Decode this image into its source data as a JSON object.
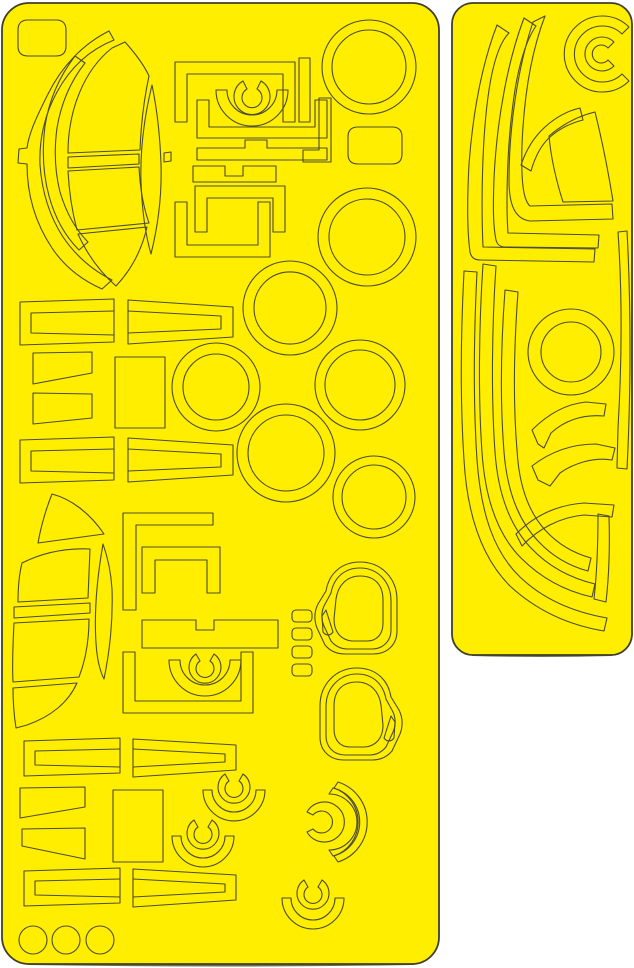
{
  "meta": {
    "content_type": "die-cut vinyl paint mask sheets scan",
    "sheet_count": 2,
    "text_content": "none"
  },
  "colors": {
    "background": "#ffffff",
    "sheet_fill": "#ffee00",
    "cut_line": "#4c4c33",
    "sheet_border": "#3f3f2a",
    "shadow": "#6e6e52"
  },
  "canvas": {
    "width": 634,
    "height": 968
  },
  "sheets": [
    {
      "name": "left-mask-sheet",
      "frame": {
        "x": 2,
        "y": 3,
        "width": 437,
        "height": 961,
        "rx": 27
      },
      "shadow": "M28,963.5 Q221,966.5 414,963.5",
      "shapes": [
        {
          "name": "corner-tab-mask",
          "path": "M28,20 H56 Q66,20 66,30 V46 Q66,56 56,56 H28 Q18,56 18,46 V30 Q18,20 28,20 Z"
        },
        {
          "name": "windshield-outer-arc-mask",
          "path": "M109,31 C83,44 62,66 48,94 C36,118 29,133 27,148 L19,149 L18,163 L27,164 C27,196 36,224 52,248 C66,269 84,281 102,289 L112,280 C92,270 76,256 63,237 C50,217 42,192 40,165 C39,139 45,114 57,92 C70,68 89,50 114,40 Z"
        },
        {
          "name": "windshield-mid-arc-mask",
          "path": "M75,56 C59,77 49,100 45,126 C42,150 43,174 49,196 C55,218 65,236 79,250 L88,242 C75,229 66,212 60,192 C55,172 54,150 57,128 C61,104 70,82 85,63 Z"
        },
        {
          "name": "windshield-top-pane-mask",
          "path": "M125,42 C134,52 143,63 149,76 C144,99 141,124 140,150 L68,153 C68,110 84,70 112,48 Z"
        },
        {
          "name": "windshield-leaf-mask",
          "path": "M152,85 C144,118 140,150 141,182 C142,210 145,233 151,254 C158,226 162,196 161,164 C160,136 157,109 152,85 Z"
        },
        {
          "name": "windshield-equator-strip-mask",
          "path": "M68,157 L139,154 L139,164 L68,168 Z"
        },
        {
          "name": "windshield-equator-stub-mask",
          "path": "M164,153 L171,152 L171,161 L164,162 Z"
        },
        {
          "name": "windshield-lower-pane-mask",
          "path": "M68,171 L139,167 C140,187 143,206 149,223 L77,230 C72,211 69,191 68,171 Z"
        },
        {
          "name": "windshield-bottom-wedge-mask",
          "path": "M78,234 L147,227 C142,249 132,269 116,286 C100,272 87,254 78,234 Z"
        },
        {
          "name": "canopy-staple-frame-mask",
          "path": "M175,62 H295 V122 H283 V74 H187 V122 H175 Z"
        },
        {
          "name": "canopy-side-bar-mask",
          "path": "M299,58 H310 V122 H299 Z"
        },
        {
          "name": "canopy-corner-bracket-mask",
          "path": "M319,98 H331 V162 H303 V150 H319 Z"
        },
        {
          "name": "canopy-u-channel-mask",
          "path": "M197,100 V138 H327 V100 H315 V127 H209 V100 Z"
        },
        {
          "name": "canopy-fan-arc-mask",
          "path": "M216,90 A36,36 0 0 0 288,90 L277,90 A25,25 0 0 1 227,90 Z"
        },
        {
          "name": "canopy-c-ring-mask",
          "path": "M261,81 A18,18 0 1 1 243,81 L247,89 A10,10 0 1 0 257,89 Z"
        },
        {
          "name": "canopy-tab-bar-mask",
          "path": "M197,148 H245 V140 H267 V148 H327 V160 H197 Z"
        },
        {
          "name": "canopy-notch-bar-mask",
          "path": "M193,166 H225 V176 H243 V166 H276 V182 H193 Z"
        },
        {
          "name": "canopy-inner-bracket-mask",
          "path": "M195,232 V186 H285 V232 H273 V198 H207 V232 Z"
        },
        {
          "name": "canopy-lower-u-frame-mask",
          "path": "M175,202 V257 H270 V202 H258 V245 H187 V202 Z"
        },
        {
          "name": "ring-mask-top-1",
          "path": "M322,67 a47,47 0 1 0 94,0 a47,47 0 1 0 -94,0 M332,67 a37,37 0 1 0 74,0 a37,37 0 1 0 -74,0"
        },
        {
          "name": "ring-mask-top-2",
          "path": "M318,237 a49,49 0 1 0 98,0 a49,49 0 1 0 -98,0 M329,237 a38,38 0 1 0 76,0 a38,38 0 1 0 -76,0"
        },
        {
          "name": "rounded-rect-mask",
          "path": "M358,127 H392 Q402,127 402,137 V154 Q402,164 392,164 H358 Q348,164 348,154 V137 Q348,127 358,127 Z"
        },
        {
          "name": "ring-mask-mid-1",
          "path": "M243,308 a47,47 0 1 0 94,0 a47,47 0 1 0 -94,0 M254,308 a36,36 0 1 0 72,0 a36,36 0 1 0 -72,0"
        },
        {
          "name": "ring-mask-mid-2",
          "path": "M172,387 a44,44 0 1 0 88,0 a44,44 0 1 0 -88,0 M183,387 a33,33 0 1 0 66,0 a33,33 0 1 0 -66,0"
        },
        {
          "name": "ring-mask-mid-3",
          "path": "M315,385 a45,45 0 1 0 90,0 a45,45 0 1 0 -90,0 M325,385 a35,35 0 1 0 70,0 a35,35 0 1 0 -70,0"
        },
        {
          "name": "ring-mask-mid-4",
          "path": "M237,453 a49,49 0 1 0 98,0 a49,49 0 1 0 -98,0 M248,453 a38,38 0 1 0 76,0 a38,38 0 1 0 -76,0"
        },
        {
          "name": "ring-mask-mid-5",
          "path": "M333,497 a41,41 0 1 0 82,0 a41,41 0 1 0 -82,0 M342,497 a32,32 0 1 0 64,0 a32,32 0 1 0 -64,0"
        },
        {
          "name": "strip-channel-row1-left-outer",
          "path": "M20,302 L114,299 L114,342 L20,345 Z"
        },
        {
          "name": "strip-channel-row1-left-inner",
          "path": "M114,311 L31,313 L31,333 L114,335"
        },
        {
          "name": "strip-channel-row1-right-outer",
          "path": "M128,300 L233,307 L233,337 L128,344 Z"
        },
        {
          "name": "strip-channel-row1-right-inner",
          "path": "M128,311 L221,316 L221,329 L128,333"
        },
        {
          "name": "trapezoid-mask-1",
          "path": "M33,353 L92,352 L92,373 L33,384 Z"
        },
        {
          "name": "trapezoid-mask-2",
          "path": "M33,393 L92,394 L92,418 L33,424 Z"
        },
        {
          "name": "rect-mask-mid",
          "path": "M115,357 H165 V428 H115 Z"
        },
        {
          "name": "strip-channel-row2-left-outer",
          "path": "M20,440 L114,437 L114,480 L20,483 Z"
        },
        {
          "name": "strip-channel-row2-left-inner",
          "path": "M114,449 L31,451 L31,471 L114,473"
        },
        {
          "name": "strip-channel-row2-right-outer",
          "path": "M128,438 L233,445 L233,475 L128,482 Z"
        },
        {
          "name": "strip-channel-row2-right-inner",
          "path": "M128,449 L221,454 L221,467 L128,471"
        },
        {
          "name": "lower-canopy-top-wedge-mask",
          "path": "M52,494 C71,499 90,513 104,534 L38,543 C41,526 46,509 52,494 Z"
        },
        {
          "name": "lower-canopy-pane-mask",
          "path": "M22,563 C44,552 67,548 90,549 L88,598 L18,602 C18,588 19,575 22,563 Z"
        },
        {
          "name": "lower-canopy-leaf-mask",
          "path": "M103,544 C97,578 94,612 96,643 C97,659 100,671 104,679 C110,650 113,619 112,589 C111,573 108,558 103,544 Z"
        },
        {
          "name": "lower-canopy-equator-strip-mask",
          "path": "M14,607 L90,603 L90,613 L14,618 Z"
        },
        {
          "name": "lower-canopy-pane2-mask",
          "path": "M14,623 L89,619 C89,639 86,659 79,677 L13,682 C12,662 13,642 14,623 Z"
        },
        {
          "name": "lower-canopy-bottom-wedge-mask",
          "path": "M13,688 L77,683 C68,703 50,717 27,725 L16,728 C14,715 13,701 13,688 Z"
        },
        {
          "name": "bracket-l-mask",
          "path": "M123,513 H213 V525 H136 V610 H123 Z"
        },
        {
          "name": "bracket-n-mask",
          "path": "M142,547 H220 V593 H207 V560 H155 V593 H142 Z"
        },
        {
          "name": "notch-bar-mask-2",
          "path": "M142,620 H196 V630 H214 V620 H278 V648 H142 Z"
        },
        {
          "name": "canopy-fan-arc-mask-2",
          "path": "M169,660 A36,36 0 0 0 241,660 L230,660 A25,25 0 0 1 180,660 Z"
        },
        {
          "name": "canopy-c-ring-mask-2",
          "path": "M214,654 A16,16 0 1 1 196,654 L200,661 A9,9 0 1 0 210,661 Z"
        },
        {
          "name": "canopy-staple-frame-mask-2",
          "path": "M123,652 V713 H253 V652 H241 V701 H135 V652 Z"
        },
        {
          "name": "small-tab-mask-1",
          "path": "M296,610 h12 a4,4 0 0 1 4,4 v4 a4,4 0 0 1 -4,4 h-12 a4,4 0 0 1 -4,-4 v-4 a4,4 0 0 1 4,-4 Z"
        },
        {
          "name": "small-tab-mask-2",
          "path": "M296,628 h12 a4,4 0 0 1 4,4 v4 a4,4 0 0 1 -4,4 h-12 a4,4 0 0 1 -4,-4 v-4 a4,4 0 0 1 4,-4 Z"
        },
        {
          "name": "small-tab-mask-3",
          "path": "M296,646 h12 a4,4 0 0 1 4,4 v4 a4,4 0 0 1 -4,4 h-12 a4,4 0 0 1 -4,-4 v-4 a4,4 0 0 1 4,-4 Z"
        },
        {
          "name": "small-tab-mask-4",
          "path": "M296,664 h12 a4,4 0 0 1 4,4 v4 a4,4 0 0 1 -4,4 h-12 a4,4 0 0 1 -4,-4 v-4 a4,4 0 0 1 4,-4 Z"
        },
        {
          "name": "wheel-mask-1-outer",
          "path": "M360,562 C342,562 329,573 326,591 L318,604 C314,612 314,620 317,628 L325,645 C330,651 337,654 345,654 L373,654 C387,654 397,645 397,631 L397,600 C397,578 381,562 360,562 Z"
        },
        {
          "name": "wheel-mask-1-mid",
          "path": "M360,568 C345,568 334,577 331,593 L324,606 C321,613 321,619 324,626 L331,641 C335,646 341,649 347,649 L372,649 C383,649 391,641 391,630 L391,601 C391,581 377,568 360,568 Z"
        },
        {
          "name": "wheel-mask-1-inner",
          "path": "M360,576 C347,576 338,585 336,599 L334,619 C334,632 341,640 352,641 L367,641 C377,641 383,634 383,623 L383,600 C383,584 374,576 360,576 Z"
        },
        {
          "name": "wheel-mask-1-wedge",
          "path": "M326,610 L333,632 C330,636 326,636 323,632 L322,616 Z"
        },
        {
          "name": "wheel-mask-2-outer",
          "path": "M357,668 C375,668 388,679 391,697 L399,710 C403,718 403,726 400,734 L392,751 C387,757 380,760 372,760 L344,760 C330,760 320,751 320,737 L320,706 C320,684 336,668 357,668 Z"
        },
        {
          "name": "wheel-mask-2-mid",
          "path": "M357,674 C372,674 383,683 386,699 L393,712 C396,719 396,725 393,732 L386,747 C382,752 376,755 370,755 L345,755 C334,755 326,747 326,736 L326,707 C326,687 340,674 357,674 Z"
        },
        {
          "name": "wheel-mask-2-inner",
          "path": "M357,682 C370,682 379,691 381,705 L383,725 C383,738 376,746 365,747 L350,747 C340,747 334,740 334,729 L334,706 C334,690 343,682 357,682 Z"
        },
        {
          "name": "wheel-mask-2-wedge",
          "path": "M391,716 L384,738 C387,742 391,742 394,738 L395,722 Z"
        },
        {
          "name": "strip-channel-rowA-left-outer",
          "path": "M24,741 L120,738 L120,773 L24,776 Z"
        },
        {
          "name": "strip-channel-rowA-left-inner",
          "path": "M120,749 L35,751 L35,765 L120,767"
        },
        {
          "name": "strip-channel-rowA-right-outer",
          "path": "M133,739 L236,745 L236,770 L133,777 Z"
        },
        {
          "name": "strip-channel-rowA-right-inner",
          "path": "M133,749 L225,754 L225,762 L133,767"
        },
        {
          "name": "trapezoid-mask-3",
          "path": "M20,788 L85,787 L85,807 L20,818 Z"
        },
        {
          "name": "trapezoid-mask-4",
          "path": "M22,829 L85,828 L85,859 L22,846 Z"
        },
        {
          "name": "rect-mask-bottom",
          "path": "M113,790 H163 V862 H113 Z"
        },
        {
          "name": "spinner-c-ring-1",
          "path": "M243,774 A16,16 0 1 1 225,774 L229,781 A9,9 0 1 0 239,781 Z"
        },
        {
          "name": "spinner-fan-1",
          "path": "M203,790 A31,31 0 0 0 265,790 L256,790 A22,22 0 0 1 212,790 Z"
        },
        {
          "name": "spinner-c-ring-2",
          "path": "M212,820 A16,16 0 1 1 194,820 L198,827 A9,9 0 1 0 208,827 Z"
        },
        {
          "name": "spinner-fan-2",
          "path": "M172,836 A31,31 0 0 0 234,836 L225,836 A22,22 0 0 1 181,836 Z"
        },
        {
          "name": "spinner-c-ring-3",
          "path": "M307,812 A20,20 0 1 1 307,832 L313,829 A11,11 0 1 0 313,815 Z"
        },
        {
          "name": "spinner-arc-3a",
          "path": "M333,856 A35,35 0 0 0 333,788 L329,794 A28,28 0 0 1 329,850 Z"
        },
        {
          "name": "spinner-arc-3b",
          "path": "M338,862 A42,42 0 0 0 338,782 L334,788 A36,36 0 0 1 334,856 Z"
        },
        {
          "name": "spinner-c-ring-4",
          "path": "M322,880 A16,16 0 1 1 304,880 L308,887 A9,9 0 1 0 318,887 Z"
        },
        {
          "name": "spinner-fan-4",
          "path": "M282,898 A31,31 0 0 0 344,898 L335,898 A22,22 0 0 1 291,898 Z"
        },
        {
          "name": "strip-channel-rowC-left-outer",
          "path": "M24,871 L120,868 L120,903 L24,906 Z"
        },
        {
          "name": "strip-channel-rowC-left-inner",
          "path": "M120,879 L35,881 L35,895 L120,897"
        },
        {
          "name": "strip-channel-rowC-right-outer",
          "path": "M133,869 L236,875 L236,900 L133,907 Z"
        },
        {
          "name": "strip-channel-rowC-right-inner",
          "path": "M133,879 L225,884 L225,892 L133,897"
        },
        {
          "name": "circle-mask-1",
          "path": "M19,940 a14,14 0 1 0 28,0 a14,14 0 1 0 -28,0"
        },
        {
          "name": "circle-mask-2",
          "path": "M52,940 a14,14 0 1 0 28,0 a14,14 0 1 0 -28,0"
        },
        {
          "name": "circle-mask-3",
          "path": "M86,940 a14,14 0 1 0 28,0 a14,14 0 1 0 -28,0"
        }
      ]
    },
    {
      "name": "right-mask-sheet",
      "frame": {
        "x": 452,
        "y": 3,
        "width": 180,
        "height": 652,
        "rx": 21
      },
      "shadow": "M472,654.5 Q542,656.5 612,654.5",
      "shapes": [
        {
          "name": "c-spiral-outer-mask",
          "path": "M629,27 A38,38 0 1 0 629,81 L622,74 A28,28 0 1 1 622,34 Z"
        },
        {
          "name": "c-spiral-inner-mask",
          "path": "M614,42 A17,17 0 1 0 614,66 L608,60 A9,9 0 1 1 608,48 Z"
        },
        {
          "name": "j-band-mask-1",
          "path": "M497,25 C482,64 473,112 469,164 C467,202 467,230 470,252 C471,257 474,260 480,260 L594,262 L595,249 L483,247 C481,203 482,136 489,90 C493,64 499,43 509,33 Z"
        },
        {
          "name": "j-band-mask-2",
          "path": "M524,18 C508,60 497,118 494,178 C493,206 493,226 496,240 C497,244 500,247 505,247 L598,248 L599,235 L508,233 C506,206 507,152 512,112 C516,76 523,45 536,26 Z"
        },
        {
          "name": "j-band-mask-3",
          "path": "M545,16 C532,50 524,95 522,145 C521,180 523,200 530,206 L612,204 L613,219 L530,221 C515,219 509,205 509,180 C509,130 517,70 533,22 Z"
        },
        {
          "name": "elbow-band-mask",
          "path": "M531,171 L521,165 C526,150 534,137 545,127 C556,117 567,111 580,108 L583,120 C571,123 559,129 550,137 C541,145 535,157 531,171 Z"
        },
        {
          "name": "canopy-panel-mask",
          "path": "M549,136 C563,124 578,116 595,112 C602,140 608,170 613,201 L563,202 C556,180 551,158 549,136 Z"
        },
        {
          "name": "right-edge-band-mask",
          "path": "M618,232 C622,290 622,360 618,428 L617,468 L627,469 C631,392 631,304 627,231 Z"
        },
        {
          "name": "k-band-mask-1",
          "path": "M464,271 C461,330 460,400 464,460 C467,512 480,556 510,586 C536,610 568,625 604,631 L607,618 C573,612 543,599 520,577 C494,552 481,514 477,460 C473,400 474,332 477,272 Z"
        },
        {
          "name": "k-band-mask-2",
          "path": "M483,264 C479,324 478,396 482,452 C485,498 497,534 521,558 C541,578 565,591 592,597 L595,584 C570,578 548,566 531,548 C510,526 498,494 495,452 C491,396 492,324 496,266 Z"
        },
        {
          "name": "k-band-mask-3",
          "path": "M505,290 C501,344 500,402 504,452 C507,490 518,520 538,541 C552,556 569,566 588,571 L591,558 C573,553 558,544 546,531 C529,513 519,486 517,450 C513,402 514,346 518,292 Z"
        },
        {
          "name": "ring-mask-right",
          "path": "M528,352 a43,43 0 1 0 86,0 a43,43 0 1 0 -86,0 M541,352 a30,30 0 1 0 60,0 a30,30 0 1 0 -60,0"
        },
        {
          "name": "kink-band-mask-1",
          "path": "M538,444 L532,430 C548,414 566,404 586,402 L606,404 L604,416 C582,414 564,421 551,433 L544,448 Z"
        },
        {
          "name": "kink-band-mask-2",
          "path": "M538,480 L532,466 C550,452 572,444 596,444 L615,448 L612,460 C594,457 574,463 560,473 L550,486 Z"
        },
        {
          "name": "step-band-mask",
          "path": "M522,546 L516,534 C534,516 556,505 584,503 L614,505 L612,517 L584,515 C560,517 538,529 522,546 Z"
        },
        {
          "name": "vertical-band-mask",
          "path": "M598,514 L609,516 C610,548 609,576 606,602 L594,599 C597,572 598,544 598,514 Z"
        }
      ]
    }
  ]
}
